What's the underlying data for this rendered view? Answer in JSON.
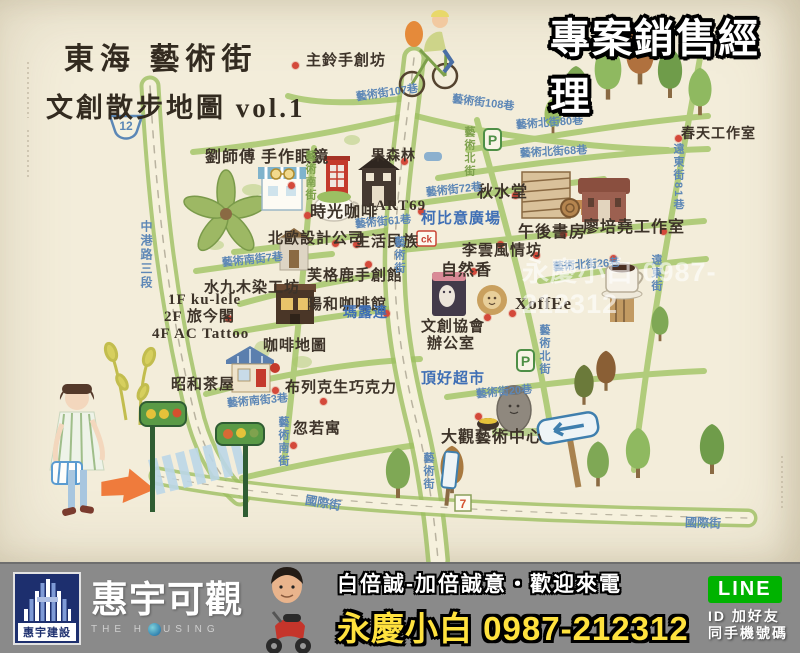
{
  "overlay": {
    "badge": "專案銷售經理",
    "watermark": "永慶小白 0987-212312"
  },
  "map": {
    "title_line1": "東海 藝術街",
    "title_line2": "文創散步地圖 vol.1",
    "signs": {
      "route": "12",
      "parking": "P",
      "ck": "ck",
      "seven": "7"
    },
    "labels": [
      {
        "t": "主鈴手創坊",
        "x": 306,
        "y": 54
      },
      {
        "t": "劉師傅 手作眼鏡",
        "x": 205,
        "y": 150,
        "s": 16
      },
      {
        "t": "時光咖啡",
        "x": 310,
        "y": 205,
        "s": 16
      },
      {
        "t": "ART69",
        "x": 375,
        "y": 199
      },
      {
        "t": "北歐設計公司",
        "x": 268,
        "y": 232
      },
      {
        "t": "生活民族",
        "x": 355,
        "y": 235
      },
      {
        "t": "果森林",
        "x": 371,
        "y": 150,
        "s": 14
      },
      {
        "t": "秋水堂",
        "x": 477,
        "y": 185,
        "s": 16
      },
      {
        "t": "午後書房",
        "x": 518,
        "y": 225,
        "s": 16
      },
      {
        "t": "廖培堯工作室",
        "x": 583,
        "y": 220,
        "s": 16
      },
      {
        "t": "春天工作室",
        "x": 681,
        "y": 128,
        "s": 14
      },
      {
        "t": "李雲風情坊",
        "x": 462,
        "y": 244
      },
      {
        "t": "自然香",
        "x": 441,
        "y": 263,
        "s": 16
      },
      {
        "t": "XoffEe",
        "x": 515,
        "y": 295,
        "s": 17
      },
      {
        "t": "芙格鹿手創館",
        "x": 307,
        "y": 269
      },
      {
        "t": "水九木染工坊",
        "x": 204,
        "y": 281
      },
      {
        "t": "陽和咖啡館",
        "x": 307,
        "y": 298
      },
      {
        "t": "咖啡地圖",
        "x": 263,
        "y": 339
      },
      {
        "t": "1F ku-lele",
        "x": 168,
        "y": 293
      },
      {
        "t": "2F 旅今閣",
        "x": 164,
        "y": 310
      },
      {
        "t": "4F AC Tattoo",
        "x": 152,
        "y": 327
      },
      {
        "t": "昭和茶屋",
        "x": 171,
        "y": 378
      },
      {
        "t": "布列克生巧克力",
        "x": 285,
        "y": 381
      },
      {
        "t": "忽若寓",
        "x": 293,
        "y": 422
      },
      {
        "t": "文創協會",
        "x": 421,
        "y": 320
      },
      {
        "t": "辦公室",
        "x": 427,
        "y": 337
      },
      {
        "t": "大觀藝術中心",
        "x": 441,
        "y": 430,
        "s": 16
      },
      {
        "t": "柯比意廣場",
        "x": 421,
        "y": 212,
        "c": "blue"
      },
      {
        "t": "瑪露連",
        "x": 343,
        "y": 307,
        "s": 14,
        "c": "blue"
      },
      {
        "t": "頂好超市",
        "x": 421,
        "y": 372,
        "c": "blue"
      },
      {
        "t": "藝術街107巷",
        "x": 356,
        "y": 88,
        "c": "st",
        "r": -8
      },
      {
        "t": "藝術街108巷",
        "x": 452,
        "y": 98,
        "c": "st",
        "r": 7
      },
      {
        "t": "藝術北街80巷",
        "x": 516,
        "y": 118,
        "c": "st",
        "r": -4
      },
      {
        "t": "藝術北街68巷",
        "x": 520,
        "y": 147,
        "c": "st",
        "r": -3
      },
      {
        "t": "藝術街72巷",
        "x": 426,
        "y": 185,
        "c": "st",
        "r": -6
      },
      {
        "t": "藝術街61巷",
        "x": 355,
        "y": 217,
        "c": "st",
        "r": -5
      },
      {
        "t": "藝術南街7巷",
        "x": 222,
        "y": 255,
        "c": "st",
        "r": -6
      },
      {
        "t": "藝術南街3巷",
        "x": 227,
        "y": 396,
        "c": "st",
        "r": -5
      },
      {
        "t": "藝術街20巷",
        "x": 476,
        "y": 387,
        "c": "st",
        "r": -5
      },
      {
        "t": "藝術北街26巷",
        "x": 553,
        "y": 260,
        "c": "st",
        "r": -4
      },
      {
        "t": "國際街",
        "x": 305,
        "y": 497,
        "c": "st",
        "r": 10,
        "s": 12
      },
      {
        "t": "國際街",
        "x": 685,
        "y": 517,
        "c": "st",
        "r": 2,
        "s": 12
      },
      {
        "t": "中港路三段",
        "x": 140,
        "y": 220,
        "c": "st",
        "v": 1,
        "s": 12
      },
      {
        "t": "藝術南街",
        "x": 304,
        "y": 150,
        "c": "stg",
        "v": 1
      },
      {
        "t": "藝術南街",
        "x": 277,
        "y": 416,
        "c": "st",
        "v": 1
      },
      {
        "t": "藝術街",
        "x": 393,
        "y": 236,
        "c": "st",
        "v": 1
      },
      {
        "t": "藝術街",
        "x": 422,
        "y": 452,
        "c": "st",
        "v": 1
      },
      {
        "t": "藝術北街",
        "x": 463,
        "y": 126,
        "c": "stg",
        "v": 1
      },
      {
        "t": "藝術北街",
        "x": 538,
        "y": 324,
        "c": "st",
        "v": 1
      },
      {
        "t": "遠東街81巷",
        "x": 672,
        "y": 143,
        "c": "st",
        "v": 1
      },
      {
        "t": "遠東街",
        "x": 650,
        "y": 254,
        "c": "st",
        "v": 1
      }
    ],
    "dots": [
      [
        292,
        62
      ],
      [
        288,
        182
      ],
      [
        304,
        212
      ],
      [
        332,
        240
      ],
      [
        353,
        241
      ],
      [
        401,
        158
      ],
      [
        512,
        192
      ],
      [
        560,
        231
      ],
      [
        660,
        228
      ],
      [
        675,
        135
      ],
      [
        533,
        252
      ],
      [
        470,
        268
      ],
      [
        509,
        310
      ],
      [
        365,
        261
      ],
      [
        383,
        310
      ],
      [
        225,
        315
      ],
      [
        272,
        387
      ],
      [
        320,
        398
      ],
      [
        290,
        442
      ],
      [
        484,
        314
      ],
      [
        475,
        413
      ],
      [
        418,
        208
      ],
      [
        610,
        255
      ],
      [
        497,
        241
      ]
    ]
  },
  "banner": {
    "logo": {
      "company": "惠宇建設",
      "brand": "惠宇可觀",
      "sub1": "THE H",
      "sub2": "USING"
    },
    "slogan": "白倍誠-加倍誠意・歡迎來電",
    "agent_name": "永慶小白",
    "phone": "0987-212312",
    "line": {
      "badge": "LINE",
      "line1": "ID 加好友",
      "line2": "同手機號碼"
    }
  }
}
